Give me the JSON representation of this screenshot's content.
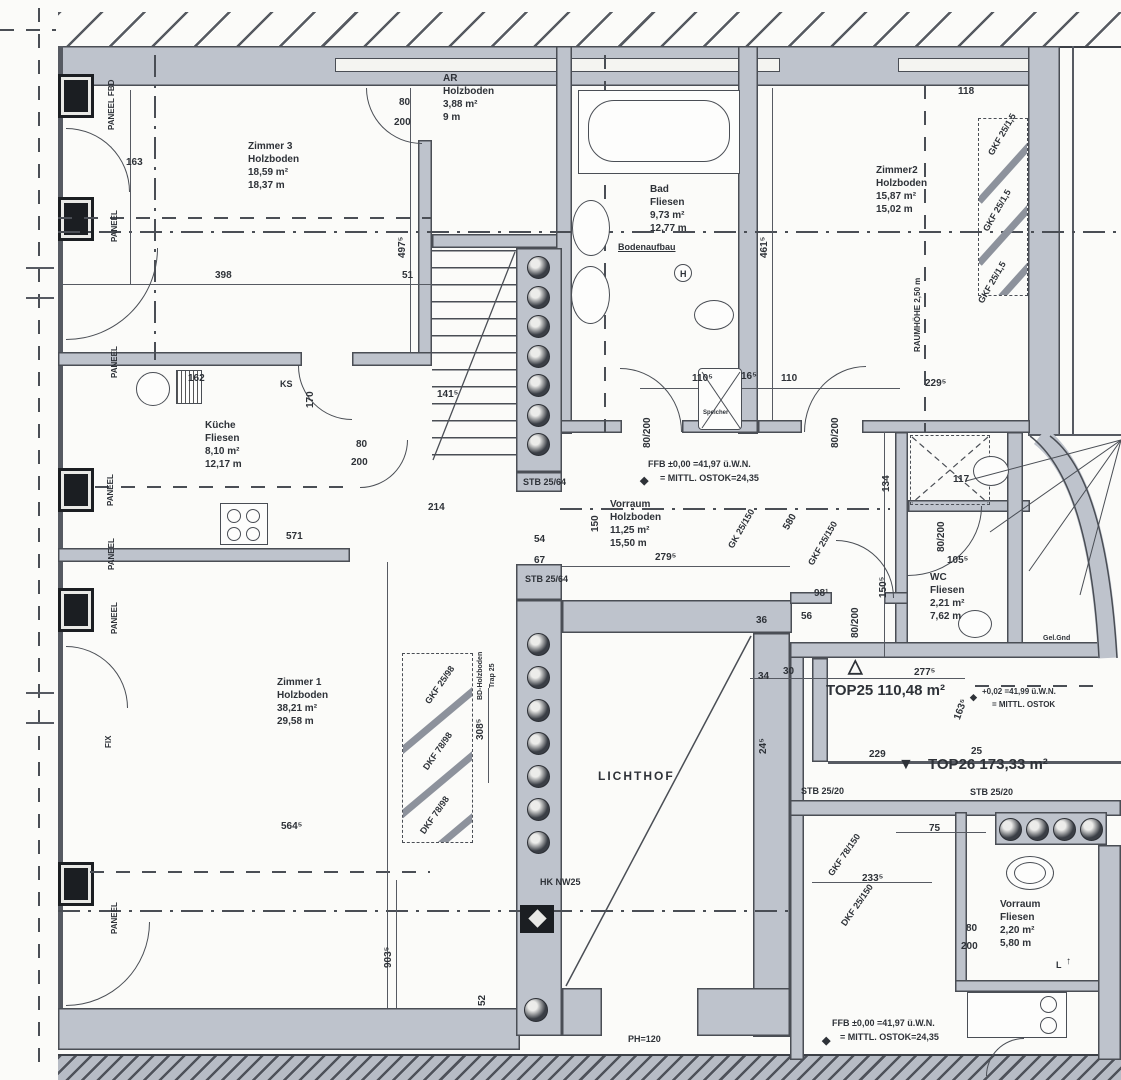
{
  "colors": {
    "wall": "#bec3cc",
    "line": "#4a4e55",
    "text": "#2e3238",
    "paper": "#fbfbf9",
    "pillar": "#1b1e22"
  },
  "blocks": [
    {
      "id": "zimmer3",
      "x": 248,
      "y": 140,
      "lines": [
        "Zimmer 3",
        "Holzboden",
        "18,59 m²",
        "18,37 m"
      ]
    },
    {
      "id": "ar",
      "x": 443,
      "y": 72,
      "lines": [
        "AR",
        "Holzboden",
        "3,88 m²",
        "9 m"
      ]
    },
    {
      "id": "bad",
      "x": 650,
      "y": 183,
      "lines": [
        "Bad",
        "Fliesen",
        "9,73 m²",
        "12,77 m"
      ]
    },
    {
      "id": "zimmer2",
      "x": 876,
      "y": 164,
      "lines": [
        "Zimmer2",
        "Holzboden",
        "15,87 m²",
        "15,02 m"
      ]
    },
    {
      "id": "kueche",
      "x": 205,
      "y": 419,
      "lines": [
        "Küche",
        "Fliesen",
        "8,10 m²",
        "12,17 m"
      ]
    },
    {
      "id": "vorraum",
      "x": 610,
      "y": 498,
      "lines": [
        "Vorraum",
        "Holzboden",
        "11,25 m²",
        "15,50 m"
      ]
    },
    {
      "id": "zimmer1",
      "x": 277,
      "y": 676,
      "lines": [
        "Zimmer 1",
        "Holzboden",
        "38,21 m²",
        "29,58 m"
      ]
    },
    {
      "id": "wc",
      "x": 930,
      "y": 571,
      "lines": [
        "WC",
        "Fliesen",
        "2,21 m²",
        "7,62 m"
      ]
    },
    {
      "id": "vorraum2",
      "x": 1000,
      "y": 898,
      "lines": [
        "Vorraum",
        "Fliesen",
        "2,20 m²",
        "5,80 m"
      ]
    }
  ],
  "labels": [
    {
      "id": "dim-163",
      "t": "163",
      "x": 126,
      "y": 158
    },
    {
      "id": "dim-398",
      "t": "398",
      "x": 215,
      "y": 271
    },
    {
      "id": "dim-51",
      "t": "51",
      "x": 402,
      "y": 271
    },
    {
      "id": "dim-497-5",
      "t": "497⁵",
      "x": 398,
      "y": 258,
      "r": -90
    },
    {
      "id": "dim-141-5",
      "t": "141⁵",
      "x": 437,
      "y": 390
    },
    {
      "id": "dim-162",
      "t": "162",
      "x": 188,
      "y": 374
    },
    {
      "id": "dim-170",
      "t": "170",
      "x": 306,
      "y": 408,
      "r": -90
    },
    {
      "id": "dim-571",
      "t": "571",
      "x": 286,
      "y": 532
    },
    {
      "id": "dim-118",
      "t": "118",
      "x": 958,
      "y": 87
    },
    {
      "id": "dim-229-5",
      "t": "229⁵",
      "x": 925,
      "y": 379
    },
    {
      "id": "dim-110-5",
      "t": "110⁵",
      "x": 692,
      "y": 374
    },
    {
      "id": "dim-16-5",
      "t": "16⁵",
      "x": 741,
      "y": 372
    },
    {
      "id": "dim-110",
      "t": "110",
      "x": 781,
      "y": 374
    },
    {
      "id": "dim-461-5",
      "t": "461⁵",
      "x": 760,
      "y": 258,
      "r": -90
    },
    {
      "id": "dim-105-5",
      "t": "105⁵",
      "x": 947,
      "y": 556
    },
    {
      "id": "dim-117",
      "t": "117",
      "x": 953,
      "y": 475
    },
    {
      "id": "dim-134",
      "t": "134",
      "x": 882,
      "y": 492,
      "r": -90
    },
    {
      "id": "dim-150-5",
      "t": "150⁵",
      "x": 879,
      "y": 598,
      "r": -90
    },
    {
      "id": "dim-279-5",
      "t": "279⁵",
      "x": 655,
      "y": 553
    },
    {
      "id": "dim-580",
      "t": "580",
      "x": 782,
      "y": 527,
      "r": -60
    },
    {
      "id": "dim-150",
      "t": "150",
      "x": 591,
      "y": 532,
      "r": -90
    },
    {
      "id": "dim-54",
      "t": "54",
      "x": 534,
      "y": 535
    },
    {
      "id": "dim-67",
      "t": "67",
      "x": 534,
      "y": 556
    },
    {
      "id": "dim-214",
      "t": "214",
      "x": 428,
      "y": 503
    },
    {
      "id": "dim-308-5",
      "t": "308⁵",
      "x": 476,
      "y": 740,
      "r": -90
    },
    {
      "id": "dim-564-5",
      "t": "564⁵",
      "x": 281,
      "y": 822
    },
    {
      "id": "dim-903-5",
      "t": "903⁵",
      "x": 384,
      "y": 968,
      "r": -90
    },
    {
      "id": "dim-52",
      "t": "52",
      "x": 478,
      "y": 1006,
      "r": -90
    },
    {
      "id": "dim-277-5",
      "t": "277⁵",
      "x": 914,
      "y": 668
    },
    {
      "id": "dim-229",
      "t": "229",
      "x": 869,
      "y": 750
    },
    {
      "id": "dim-25",
      "t": "25",
      "x": 971,
      "y": 747
    },
    {
      "id": "dim-75",
      "t": "75",
      "x": 929,
      "y": 824
    },
    {
      "id": "dim-163-5",
      "t": "163⁵",
      "x": 953,
      "y": 718,
      "r": -70
    },
    {
      "id": "dim-233-5",
      "t": "233⁵",
      "x": 862,
      "y": 874
    },
    {
      "id": "dim-34",
      "t": "34",
      "x": 758,
      "y": 672
    },
    {
      "id": "dim-30",
      "t": "30",
      "x": 783,
      "y": 667
    },
    {
      "id": "dim-36",
      "t": "36",
      "x": 756,
      "y": 616
    },
    {
      "id": "dim-98-1",
      "t": "98¹",
      "x": 814,
      "y": 589
    },
    {
      "id": "dim-56",
      "t": "56",
      "x": 801,
      "y": 612
    },
    {
      "id": "dim-24-5",
      "t": "24⁵",
      "x": 759,
      "y": 754,
      "r": -90
    },
    {
      "id": "door-ar-80",
      "t": "80",
      "x": 399,
      "y": 98
    },
    {
      "id": "door-ar-200",
      "t": "200",
      "x": 394,
      "y": 118
    },
    {
      "id": "door-kue-80",
      "t": "80",
      "x": 356,
      "y": 440
    },
    {
      "id": "door-kue-200",
      "t": "200",
      "x": 351,
      "y": 458
    },
    {
      "id": "door-bad",
      "t": "80/200",
      "x": 643,
      "y": 448,
      "r": -90
    },
    {
      "id": "door-z2",
      "t": "80/200",
      "x": 831,
      "y": 448,
      "r": -90
    },
    {
      "id": "door-wc",
      "t": "80/200",
      "x": 937,
      "y": 552,
      "r": -90
    },
    {
      "id": "door-flur",
      "t": "80/200",
      "x": 851,
      "y": 638,
      "r": -90
    },
    {
      "id": "door-br-80",
      "t": "80",
      "x": 966,
      "y": 924
    },
    {
      "id": "door-br-200",
      "t": "200",
      "x": 961,
      "y": 942
    },
    {
      "id": "tag-stb2564-a",
      "t": "STB 25/64",
      "x": 523,
      "y": 477,
      "fs": 9
    },
    {
      "id": "tag-stb2564-b",
      "t": "STB 25/64",
      "x": 525,
      "y": 574,
      "fs": 9
    },
    {
      "id": "tag-stb2520-a",
      "t": "STB 25/20",
      "x": 801,
      "y": 786,
      "fs": 9
    },
    {
      "id": "tag-stb2520-b",
      "t": "STB 25/20",
      "x": 970,
      "y": 787,
      "fs": 9
    },
    {
      "id": "tag-gkf15-a",
      "t": "GKF 25/1,5",
      "x": 986,
      "y": 152,
      "r": -60,
      "fs": 9
    },
    {
      "id": "tag-gkf15-b",
      "t": "GKF 25/1,5",
      "x": 981,
      "y": 228,
      "r": -60,
      "fs": 9
    },
    {
      "id": "tag-gkf15-c",
      "t": "GKF 25/1,5",
      "x": 976,
      "y": 300,
      "r": -60,
      "fs": 9
    },
    {
      "id": "tag-gk25150",
      "t": "GK 25/150",
      "x": 726,
      "y": 545,
      "r": -60,
      "fs": 9
    },
    {
      "id": "tag-gkf25150",
      "t": "GKF 25/150",
      "x": 806,
      "y": 562,
      "r": -60,
      "fs": 9
    },
    {
      "id": "tag-gkf2598",
      "t": "GKF 25/98",
      "x": 423,
      "y": 700,
      "r": -55,
      "fs": 9
    },
    {
      "id": "tag-dkf7898-a",
      "t": "DKF 78/98",
      "x": 421,
      "y": 766,
      "r": -55,
      "fs": 9
    },
    {
      "id": "tag-dkf7898-b",
      "t": "DKF 78/98",
      "x": 418,
      "y": 830,
      "r": -55,
      "fs": 9
    },
    {
      "id": "tag-gkf78150",
      "t": "GKF 78/150",
      "x": 826,
      "y": 872,
      "r": -55,
      "fs": 9
    },
    {
      "id": "tag-dkf25150",
      "t": "DKF 25/150",
      "x": 839,
      "y": 922,
      "r": -55,
      "fs": 9
    },
    {
      "id": "ann-paneel-fbd",
      "t": "PANEEL FBD",
      "x": 107,
      "y": 130,
      "r": -90,
      "fs": 8
    },
    {
      "id": "ann-paneel-1",
      "t": "PANEEL",
      "x": 110,
      "y": 242,
      "r": -90,
      "fs": 8
    },
    {
      "id": "ann-paneel-2",
      "t": "PANEEL",
      "x": 110,
      "y": 378,
      "r": -90,
      "fs": 8
    },
    {
      "id": "ann-paneel-3",
      "t": "PANEEL",
      "x": 106,
      "y": 506,
      "r": -90,
      "fs": 8
    },
    {
      "id": "ann-paneel-4",
      "t": "PANEEL",
      "x": 107,
      "y": 570,
      "r": -90,
      "fs": 8
    },
    {
      "id": "ann-paneel-5",
      "t": "PANEEL",
      "x": 110,
      "y": 634,
      "r": -90,
      "fs": 8
    },
    {
      "id": "ann-fix",
      "t": "FIX",
      "x": 104,
      "y": 748,
      "r": -90,
      "fs": 8
    },
    {
      "id": "ann-paneel-6",
      "t": "PANEEL",
      "x": 110,
      "y": 934,
      "r": -90,
      "fs": 8
    },
    {
      "id": "ann-ks",
      "t": "KS",
      "x": 280,
      "y": 379,
      "fs": 9
    },
    {
      "id": "ann-hk",
      "t": "HK NW25",
      "x": 540,
      "y": 877,
      "fs": 9
    },
    {
      "id": "ann-ph120",
      "t": "PH=120",
      "x": 628,
      "y": 1034,
      "fs": 9
    },
    {
      "id": "ann-gelgnd",
      "t": "Gel.Gnd",
      "x": 1043,
      "y": 634,
      "fs": 7
    },
    {
      "id": "ann-bodenaufbau",
      "t": "Bodenaufbau",
      "x": 618,
      "y": 242,
      "fs": 9,
      "u": 1
    },
    {
      "id": "ann-raumhoehe",
      "t": "RAUMHÖHE 2,50 m",
      "x": 913,
      "y": 352,
      "r": -90,
      "fs": 8
    },
    {
      "id": "ann-bd-holzboden",
      "t": "BD-Holzboden",
      "x": 476,
      "y": 700,
      "r": -90,
      "fs": 7
    },
    {
      "id": "ann-trap25",
      "t": "Trap 25",
      "x": 488,
      "y": 688,
      "r": -90,
      "fs": 7
    },
    {
      "id": "ann-speicher",
      "t": "Speicher",
      "x": 703,
      "y": 408,
      "fs": 6
    },
    {
      "id": "ann-h-symbol",
      "t": "H",
      "x": 680,
      "y": 269,
      "fs": 9
    },
    {
      "id": "ann-l-mark",
      "t": "L",
      "x": 1056,
      "y": 960,
      "fs": 9
    },
    {
      "id": "ann-l-arrow",
      "t": "↑",
      "x": 1066,
      "y": 957,
      "fs": 10
    },
    {
      "id": "ann-lichthof",
      "t": "LICHTHOF",
      "x": 598,
      "y": 771,
      "fs": 12,
      "ls": 2
    },
    {
      "id": "lvl-ffb-mid",
      "t": "FFB ±0,00 =41,97 ü.W.N.",
      "x": 648,
      "y": 459,
      "fs": 9
    },
    {
      "id": "lvl-ostok-mid",
      "t": "= MITTL. OSTOK=24,35",
      "x": 660,
      "y": 473,
      "fs": 9
    },
    {
      "id": "lvl-marker-mid",
      "t": "◆",
      "x": 640,
      "y": 476,
      "fs": 11
    },
    {
      "id": "lvl-plus002",
      "t": "+0,02 =41,99 ü.W.N.",
      "x": 982,
      "y": 687,
      "fs": 8
    },
    {
      "id": "lvl-ostok-tr",
      "t": "= MITTL. OSTOK",
      "x": 992,
      "y": 700,
      "fs": 8
    },
    {
      "id": "lvl-marker-tr",
      "t": "◆",
      "x": 970,
      "y": 692,
      "fs": 9
    },
    {
      "id": "lvl-ffb-br",
      "t": "FFB ±0,00 =41,97 ü.W.N.",
      "x": 832,
      "y": 1018,
      "fs": 9
    },
    {
      "id": "lvl-ostok-br",
      "t": "= MITTL. OSTOK=24,35",
      "x": 840,
      "y": 1032,
      "fs": 9
    },
    {
      "id": "lvl-marker-br",
      "t": "◆",
      "x": 822,
      "y": 1036,
      "fs": 11
    },
    {
      "id": "unit-top25-label",
      "t": "TOP25 110,48 m²",
      "x": 826,
      "y": 686,
      "fs": 15,
      "b": 1
    },
    {
      "id": "unit-top25-marker",
      "t": "△",
      "x": 848,
      "y": 662,
      "fs": 19
    },
    {
      "id": "unit-top26-label",
      "t": "TOP26 173,33 m²",
      "x": 928,
      "y": 760,
      "fs": 15,
      "b": 1
    },
    {
      "id": "unit-top26-marker",
      "t": "▼",
      "x": 898,
      "y": 760,
      "fs": 16
    }
  ],
  "shaft_circles": {
    "upper_column_count": 7,
    "lower_column_count": 7,
    "bottom_right_count": 4
  }
}
